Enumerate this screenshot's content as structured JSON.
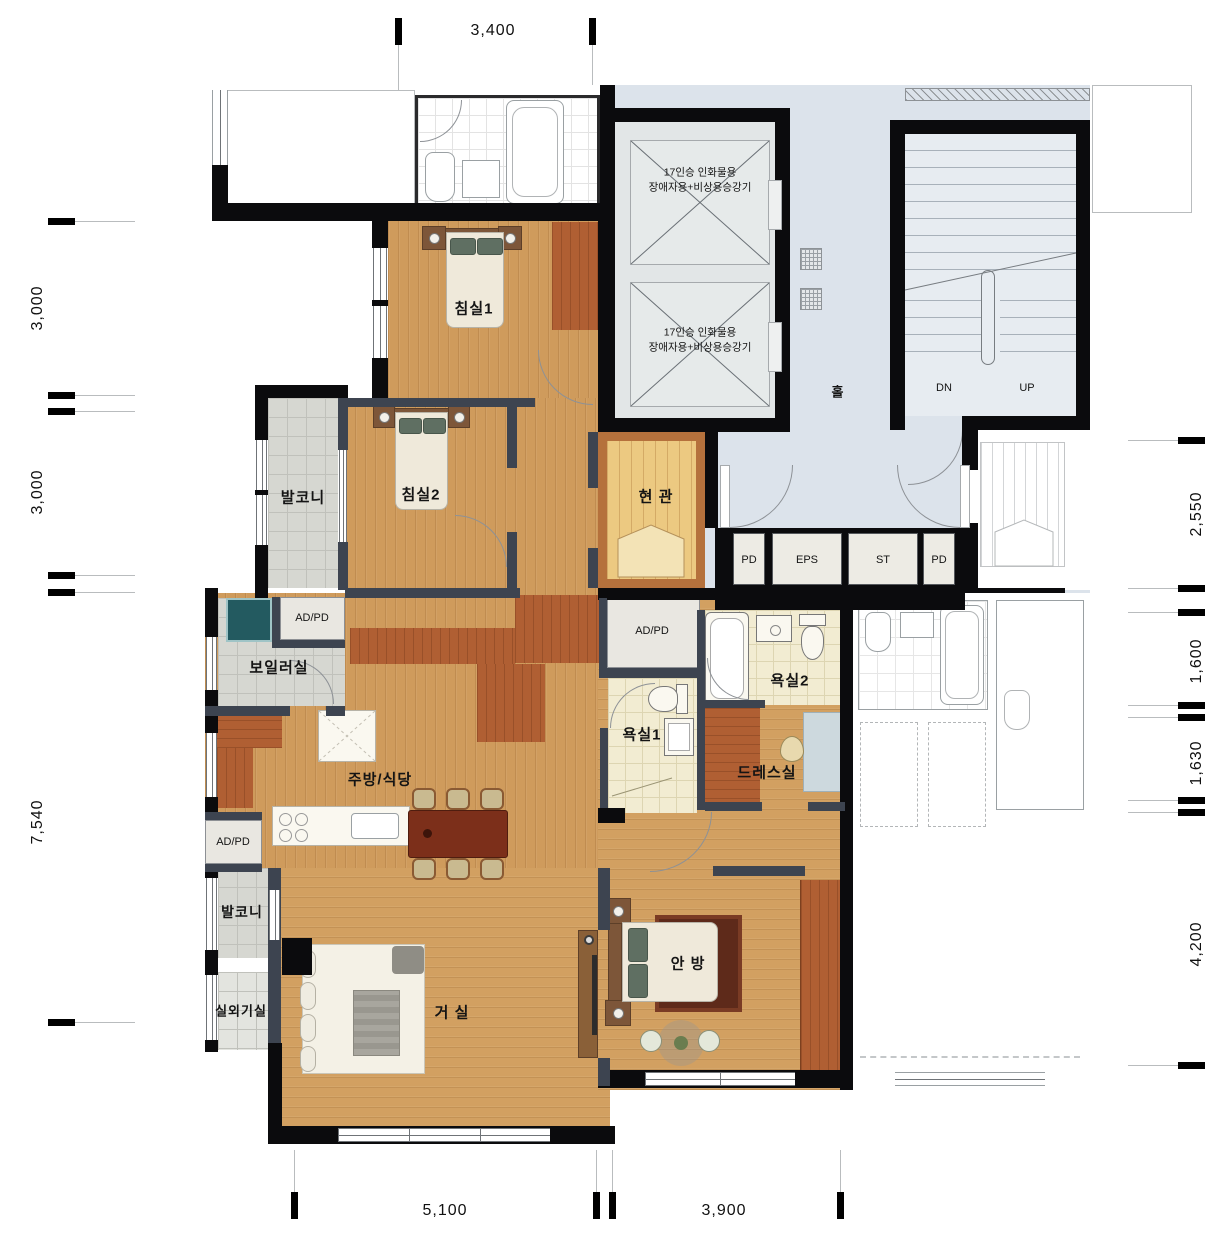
{
  "plan": {
    "unit_rooms": {
      "bedroom1": "침실1",
      "bedroom2": "침실2",
      "balcony_upper": "발코니",
      "boiler_room": "보일러실",
      "kitchen_dining": "주방/식당",
      "living_room": "거 실",
      "balcony_lower": "발코니",
      "outdoor_unit_room": "실외기실",
      "entrance": "현 관",
      "bathroom1": "욕실1",
      "bathroom2": "욕실2",
      "dress_room": "드레스실",
      "master_bedroom": "안 방"
    },
    "core": {
      "hall": "홀",
      "elevator1_line1": "17인승 인화물용",
      "elevator1_line2": "장애자용+비상용승강기",
      "elevator2_line1": "17인승 인화물용",
      "elevator2_line2": "장애자용+비상용승강기",
      "stair_down": "DN",
      "stair_up": "UP"
    },
    "shafts": {
      "pd_left": "PD",
      "eps": "EPS",
      "st": "ST",
      "pd_right": "PD",
      "adpd_boiler": "AD/PD",
      "adpd_kitchen": "AD/PD",
      "adpd_hall": "AD/PD"
    },
    "dimensions": {
      "top": [
        "3,400"
      ],
      "left": [
        "3,000",
        "3,000",
        "7,540"
      ],
      "right": [
        "2,550",
        "1,600",
        "1,630",
        "4,200"
      ],
      "bottom": [
        "5,100",
        "3,900"
      ]
    },
    "colors": {
      "wall": "#0b0b0d",
      "interior_wall": "#3d4450",
      "wood_floor": "#cf9b5c",
      "accent_wood": "#b05f33",
      "hall_floor": "#dce3eb",
      "entrance_floor": "#ecc981",
      "bath_floor": "#f2ecd2",
      "balcony_floor": "#d6d7d1"
    }
  }
}
